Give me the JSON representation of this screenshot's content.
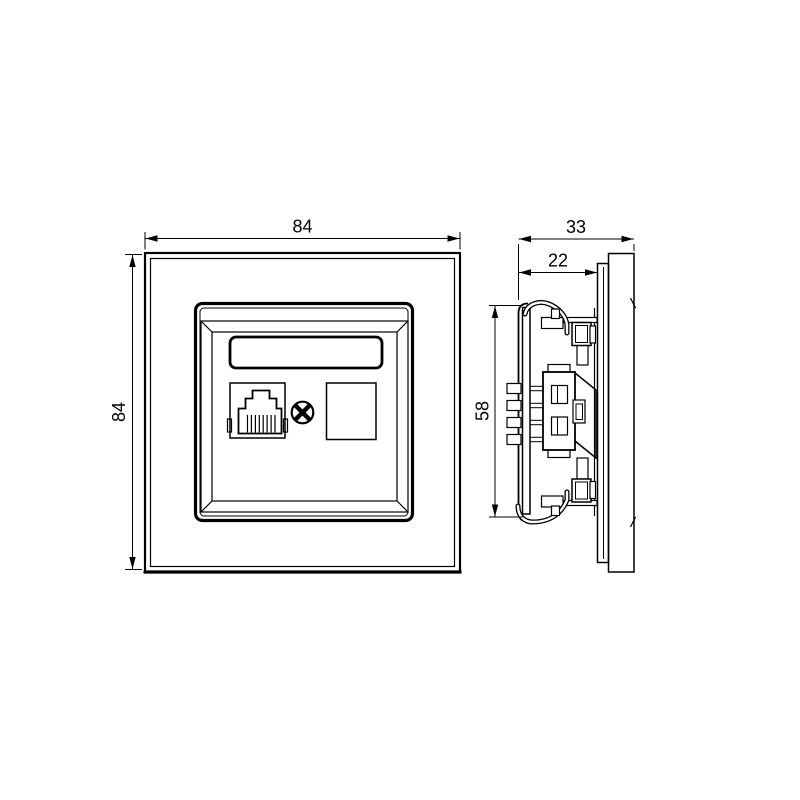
{
  "colors": {
    "background": "#ffffff",
    "line": "#000000"
  },
  "drawing": {
    "kind": "technical-dimension-drawing",
    "front_view": {
      "dim_width": "84",
      "dim_height": "84",
      "features": [
        "cover-frame",
        "center-plate",
        "label-window",
        "rj45-port",
        "fixing-screw",
        "blank-module"
      ]
    },
    "side_view": {
      "dim_depth_total": "33",
      "dim_depth_front": "22",
      "dim_height": "58",
      "features": [
        "mounting-claws",
        "terminal-block",
        "cover-frame-profile"
      ]
    }
  }
}
